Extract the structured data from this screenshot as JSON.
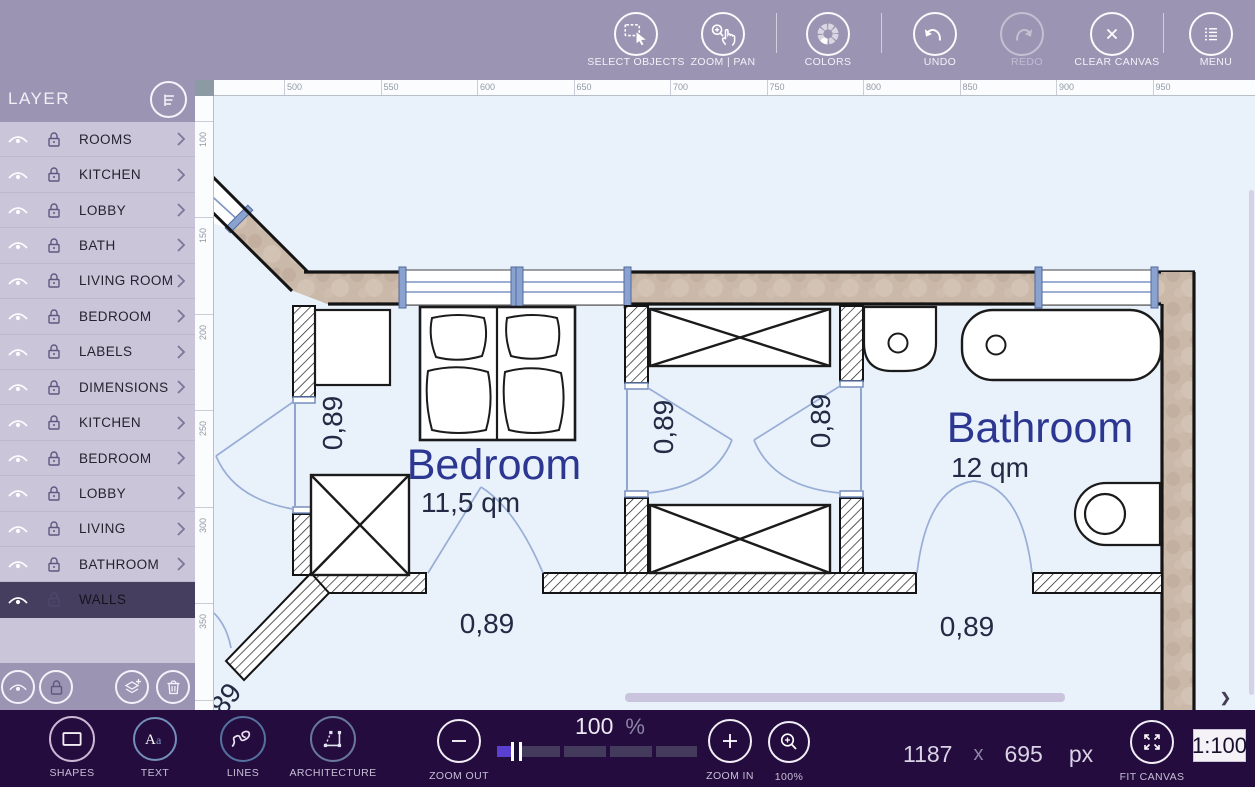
{
  "colors": {
    "toolbar_bg": "#9c94b3",
    "dark_toolbar_bg": "#250c3e",
    "selected_row_bg": "#453e5f",
    "canvas_bg": "#e9f1fb",
    "accent_slider": "#5b3fd0",
    "wall_tan": "#cab8a9",
    "room_label": "#2c3792",
    "dim_label": "#222a44",
    "door_arc": "#98aed6",
    "window_blue": "#7d95c6"
  },
  "top_toolbar": {
    "buttons": [
      {
        "label": "SELECT OBJECTS"
      },
      {
        "label": "ZOOM | PAN"
      },
      {
        "label": "COLORS"
      },
      {
        "label": "UNDO"
      },
      {
        "label": "REDO",
        "disabled": true
      },
      {
        "label": "CLEAR CANVAS"
      },
      {
        "label": "MENU"
      }
    ]
  },
  "layer_panel": {
    "title": "LAYER",
    "items": [
      {
        "label": "ROOMS"
      },
      {
        "label": "KITCHEN"
      },
      {
        "label": "LOBBY"
      },
      {
        "label": "BATH"
      },
      {
        "label": "LIVING ROOM"
      },
      {
        "label": "BEDROOM"
      },
      {
        "label": "LABELS"
      },
      {
        "label": "DIMENSIONS"
      },
      {
        "label": "KITCHEN"
      },
      {
        "label": "BEDROOM"
      },
      {
        "label": "LOBBY"
      },
      {
        "label": "LIVING"
      },
      {
        "label": "BATHROOM"
      },
      {
        "label": "WALLS",
        "selected": true
      }
    ]
  },
  "bottom_toolbar": {
    "tools": [
      {
        "label": "SHAPES"
      },
      {
        "label": "TEXT"
      },
      {
        "label": "LINES"
      },
      {
        "label": "ARCHITECTURE"
      }
    ],
    "zoom_out_label": "ZOOM OUT",
    "zoom_in_label": "ZOOM IN",
    "zoom_reset_label": "100%",
    "fit_canvas_label": "FIT CANVAS",
    "zoom_value": "100",
    "percent_sign": "%",
    "canvas_width": "1187",
    "times_sign": "x",
    "canvas_height": "695",
    "unit": "px",
    "scale": "1:100"
  },
  "canvas": {
    "h_ruler_ticks": [
      "500",
      "550",
      "600",
      "650",
      "700",
      "750",
      "800",
      "850",
      "900",
      "950"
    ],
    "v_ruler_ticks": [
      "100",
      "150",
      "200",
      "250",
      "300",
      "350",
      "400"
    ],
    "rooms": {
      "bedroom": {
        "name": "Bedroom",
        "area": "11,5 qm"
      },
      "bathroom": {
        "name": "Bathroom",
        "area": "12 qm"
      }
    },
    "dims": [
      "0,89",
      "0,89",
      "0,89",
      "0,89",
      "0,89",
      "0,89"
    ]
  }
}
